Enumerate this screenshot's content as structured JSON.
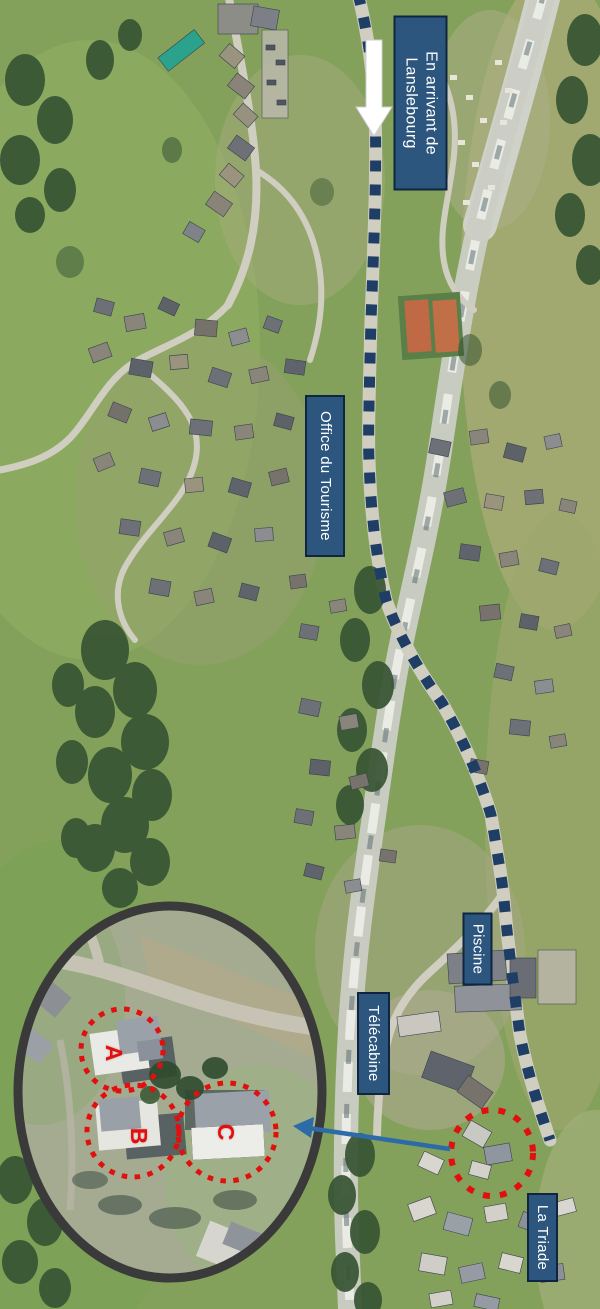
{
  "map": {
    "region_labels": {
      "arrival": {
        "line1": "En arrivant de",
        "line2": "Lanslebourg"
      },
      "tourism_office": {
        "text": "Office du Tourisme"
      },
      "pool": {
        "text": "Piscine"
      },
      "gondola": {
        "text": "Télécabine"
      },
      "residence": {
        "text": "La Triade"
      }
    },
    "inset": {
      "building_markers": [
        {
          "label": "A"
        },
        {
          "label": "B"
        },
        {
          "label": "C"
        }
      ]
    },
    "route": {
      "style": "dashed",
      "color": "#1F3E66"
    },
    "colors": {
      "label_box_bg": "#2D567E",
      "label_box_border": "#0F2540",
      "label_text": "#FFFFFF",
      "marker_red": "#E20F0F",
      "inset_ring": "#3A3A3A",
      "pointer_arrow_blue": "#2C6BA8",
      "direction_arrow_white": "#FFFFFF"
    }
  }
}
